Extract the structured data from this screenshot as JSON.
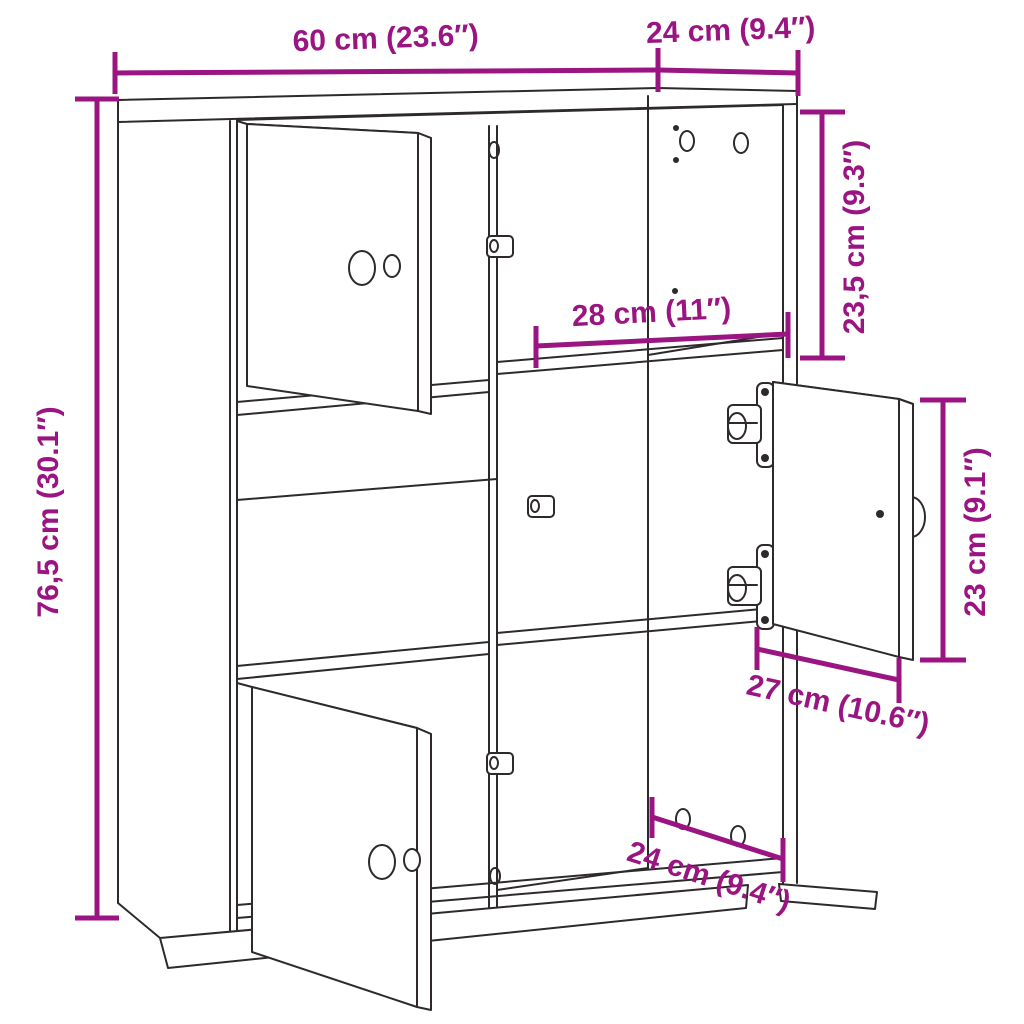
{
  "diagram": {
    "subject": "bookcase-with-six-compartments-and-three-doors",
    "background_color": "#ffffff",
    "drawing_line_color": "#2e2a2c",
    "dimension_color": "#9a1582",
    "dimensions": {
      "overall_width": {
        "label": "60 cm (23.6″)"
      },
      "top_depth": {
        "label": "24 cm (9.4″)"
      },
      "overall_height": {
        "label": "76,5 cm (30.1″)"
      },
      "top_compartment_height": {
        "label": "23,5 cm (9.3″)"
      },
      "compartment_width": {
        "label": "28 cm (11″)"
      },
      "door_height": {
        "label": "23 cm (9.1″)"
      },
      "door_width": {
        "label": "27 cm (10.6″)"
      },
      "bottom_depth": {
        "label": "24 cm (9.4″)"
      }
    }
  }
}
